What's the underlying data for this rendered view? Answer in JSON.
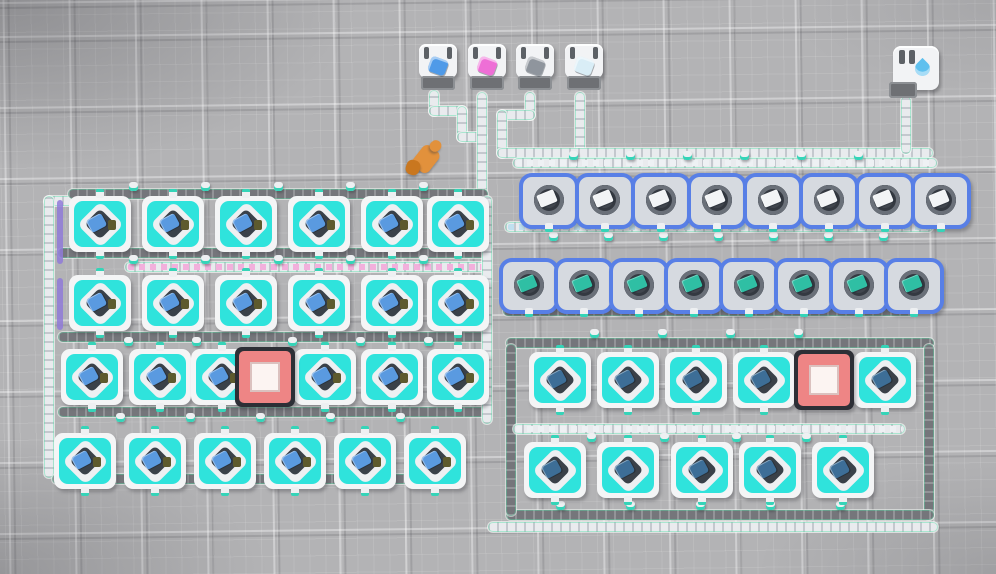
{
  "meta": {
    "app": "factory-builder-game",
    "view": "top-down planetary base",
    "canvas": {
      "width": 996,
      "height": 574
    }
  },
  "palette": {
    "ground": "#b3b3b5",
    "machine_teal": "#2fe3dc",
    "smelter_blue": "#587fe6",
    "substation_red": "#ee8585",
    "belt_dark": "#75767b",
    "belt_light": "#e9ebee",
    "mecha_orange": "#e2913c",
    "mecha_orange_dark": "#c9771f",
    "water_blue": "#5fc0ee"
  },
  "storages": [
    {
      "x": 419,
      "y": 44,
      "item": "blue-crystal-item",
      "color": "#4f9ae8"
    },
    {
      "x": 468,
      "y": 44,
      "item": "pink-crystal-item",
      "color": "#ee6fd6"
    },
    {
      "x": 516,
      "y": 44,
      "item": "gray-ore-item",
      "color": "#8f959d"
    },
    {
      "x": 565,
      "y": 44,
      "item": "white-crystal-item",
      "color": "#d9edf6"
    }
  ],
  "fluid_tank": {
    "x": 893,
    "y": 46,
    "w": 46,
    "h": 52,
    "item": "water-droplet"
  },
  "player_mecha": {
    "x": 404,
    "y": 138
  },
  "substations": [
    {
      "x": 265,
      "y": 377
    },
    {
      "x": 824,
      "y": 380
    }
  ],
  "machine_rows": [
    {
      "type": "assembler",
      "y": 224,
      "xs": [
        100,
        173,
        246,
        319,
        392,
        458
      ],
      "item": "#5a9ae0",
      "accent": "#5d5a2e"
    },
    {
      "type": "assembler",
      "y": 303,
      "xs": [
        100,
        173,
        246,
        319,
        392,
        458
      ],
      "item": "#5a9ae0",
      "accent": "#5d5a2e"
    },
    {
      "type": "assembler",
      "y": 377,
      "xs": [
        92,
        160,
        222,
        325,
        392,
        458
      ],
      "item": "#5a9ae0",
      "accent": "#5d5a2e"
    },
    {
      "type": "assembler",
      "y": 461,
      "xs": [
        85,
        155,
        225,
        295,
        365,
        435
      ],
      "item": "#5a9ae0",
      "accent": "#5d5a2e"
    },
    {
      "type": "smelter",
      "y": 197,
      "xs": [
        545,
        601,
        657,
        713,
        769,
        825,
        881,
        937
      ],
      "item": "#f2f4f6"
    },
    {
      "type": "smelter",
      "y": 282,
      "xs": [
        525,
        580,
        635,
        690,
        745,
        800,
        855,
        910
      ],
      "item": "#2fbfa4"
    },
    {
      "type": "assembler",
      "y": 380,
      "xs": [
        560,
        628,
        696,
        764,
        885
      ],
      "item": "#3d6e97"
    },
    {
      "type": "assembler",
      "y": 470,
      "xs": [
        555,
        628,
        702,
        770,
        843
      ],
      "item": "#3d6e97"
    }
  ],
  "belts": [
    {
      "x": 429,
      "y": 90,
      "w": 10,
      "h": 26,
      "kind": "light"
    },
    {
      "x": 429,
      "y": 106,
      "w": 38,
      "h": 10,
      "kind": "light"
    },
    {
      "x": 457,
      "y": 106,
      "w": 10,
      "h": 36,
      "kind": "light"
    },
    {
      "x": 457,
      "y": 132,
      "w": 30,
      "h": 10,
      "kind": "light"
    },
    {
      "x": 477,
      "y": 92,
      "w": 10,
      "h": 116,
      "kind": "light"
    },
    {
      "x": 525,
      "y": 92,
      "w": 10,
      "h": 28,
      "kind": "light"
    },
    {
      "x": 497,
      "y": 110,
      "w": 38,
      "h": 10,
      "kind": "light"
    },
    {
      "x": 497,
      "y": 110,
      "w": 10,
      "h": 48,
      "kind": "light"
    },
    {
      "x": 575,
      "y": 92,
      "w": 10,
      "h": 64,
      "kind": "light"
    },
    {
      "x": 497,
      "y": 148,
      "w": 436,
      "h": 10,
      "kind": "light"
    },
    {
      "x": 901,
      "y": 96,
      "w": 10,
      "h": 58,
      "kind": "light"
    },
    {
      "x": 44,
      "y": 196,
      "w": 42,
      "h": 10,
      "kind": "light"
    },
    {
      "x": 44,
      "y": 196,
      "w": 10,
      "h": 282,
      "kind": "light"
    },
    {
      "x": 52,
      "y": 474,
      "w": 400,
      "h": 10,
      "kind": "dark"
    },
    {
      "x": 68,
      "y": 189,
      "w": 420,
      "h": 10,
      "kind": "dark"
    },
    {
      "x": 58,
      "y": 248,
      "w": 430,
      "h": 10,
      "kind": "dark"
    },
    {
      "x": 125,
      "y": 262,
      "w": 362,
      "h": 10,
      "kind": "light",
      "items": "#f2b0dc"
    },
    {
      "x": 58,
      "y": 332,
      "w": 430,
      "h": 10,
      "kind": "dark"
    },
    {
      "x": 58,
      "y": 407,
      "w": 432,
      "h": 10,
      "kind": "dark"
    },
    {
      "x": 482,
      "y": 196,
      "w": 10,
      "h": 228,
      "kind": "light"
    },
    {
      "x": 513,
      "y": 158,
      "w": 424,
      "h": 10,
      "kind": "light",
      "items": "#eef1f4"
    },
    {
      "x": 505,
      "y": 222,
      "w": 428,
      "h": 10,
      "kind": "light",
      "items": "#bfe0ef"
    },
    {
      "x": 503,
      "y": 306,
      "w": 414,
      "h": 10,
      "kind": "dark"
    },
    {
      "x": 506,
      "y": 338,
      "w": 428,
      "h": 10,
      "kind": "dark"
    },
    {
      "x": 924,
      "y": 344,
      "w": 10,
      "h": 176,
      "kind": "dark"
    },
    {
      "x": 506,
      "y": 510,
      "w": 428,
      "h": 10,
      "kind": "dark"
    },
    {
      "x": 506,
      "y": 344,
      "w": 10,
      "h": 172,
      "kind": "dark"
    },
    {
      "x": 513,
      "y": 424,
      "w": 392,
      "h": 10,
      "kind": "light",
      "items": "#eef1f4"
    },
    {
      "x": 488,
      "y": 522,
      "w": 450,
      "h": 10,
      "kind": "light"
    }
  ],
  "accents": [
    {
      "x": 57,
      "y": 200,
      "w": 6,
      "h": 64,
      "color": "#8f7ad8"
    },
    {
      "x": 57,
      "y": 278,
      "w": 6,
      "h": 52,
      "color": "#8f7ad8"
    }
  ],
  "pole_rows": [
    {
      "y": 186,
      "xs": [
        133,
        205,
        278,
        350,
        423
      ]
    },
    {
      "y": 259,
      "xs": [
        133,
        205,
        278,
        350,
        423
      ]
    },
    {
      "y": 341,
      "xs": [
        128,
        196,
        292,
        360,
        428
      ]
    },
    {
      "y": 417,
      "xs": [
        120,
        190,
        260,
        330,
        400
      ]
    },
    {
      "y": 155,
      "xs": [
        573,
        630,
        687,
        744,
        801,
        858
      ]
    },
    {
      "y": 236,
      "xs": [
        553,
        608,
        663,
        718,
        773,
        828,
        883
      ]
    },
    {
      "y": 333,
      "xs": [
        594,
        662,
        730,
        798
      ]
    },
    {
      "y": 437,
      "xs": [
        591,
        664,
        736,
        806
      ]
    },
    {
      "y": 505,
      "xs": [
        560,
        630,
        700,
        770,
        840
      ]
    }
  ]
}
